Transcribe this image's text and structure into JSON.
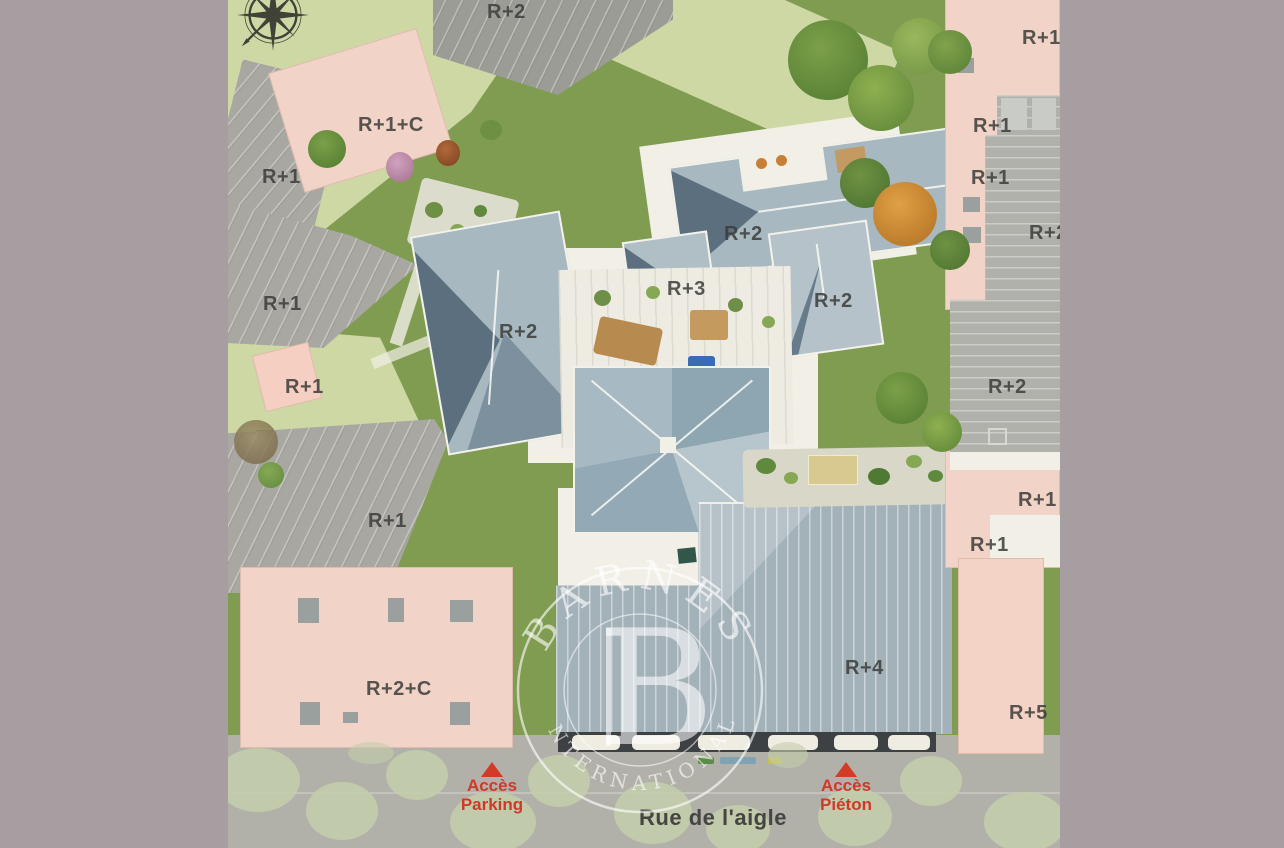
{
  "plan": {
    "building_labels": [
      {
        "text": "R+2",
        "x": 487,
        "y": 1
      },
      {
        "text": "R+1+C",
        "x": 358,
        "y": 114
      },
      {
        "text": "R+1",
        "x": 262,
        "y": 166
      },
      {
        "text": "R+1",
        "x": 263,
        "y": 293
      },
      {
        "text": "R+1",
        "x": 285,
        "y": 376
      },
      {
        "text": "R+2",
        "x": 499,
        "y": 321
      },
      {
        "text": "R+3",
        "x": 667,
        "y": 278
      },
      {
        "text": "R+2",
        "x": 724,
        "y": 223
      },
      {
        "text": "R+2",
        "x": 814,
        "y": 290
      },
      {
        "text": "R+1",
        "x": 368,
        "y": 510
      },
      {
        "text": "R+2+C",
        "x": 366,
        "y": 678
      },
      {
        "text": "R+4",
        "x": 845,
        "y": 657
      },
      {
        "text": "R+1",
        "x": 1022,
        "y": 27
      },
      {
        "text": "R+1",
        "x": 973,
        "y": 115
      },
      {
        "text": "R+1",
        "x": 971,
        "y": 167
      },
      {
        "text": "R+2",
        "x": 1029,
        "y": 222
      },
      {
        "text": "R+2",
        "x": 988,
        "y": 376
      },
      {
        "text": "R+1",
        "x": 1018,
        "y": 489
      },
      {
        "text": "R+1",
        "x": 970,
        "y": 534
      },
      {
        "text": "R+5",
        "x": 1009,
        "y": 702
      }
    ],
    "street": {
      "name": "Rue de l'aigle",
      "access_points": [
        {
          "line1": "Accès",
          "line2": "Parking",
          "x": 537,
          "y": 762
        },
        {
          "line1": "Accès",
          "line2": "Piéton",
          "x": 891,
          "y": 762
        }
      ]
    }
  },
  "watermark": {
    "letter": "B",
    "top_text": "BARNES",
    "bottom_text": "INTERNATIONAL"
  },
  "colors": {
    "mat_background": "#a69ea1",
    "access_red": "#d23b28",
    "label_text": "#3c3c3a",
    "lawn_green": "#7f9c50",
    "pale_green": "#cdd8a4",
    "building_pink": "#f1d3c7",
    "zinc_roof": "#a7b8c0"
  }
}
